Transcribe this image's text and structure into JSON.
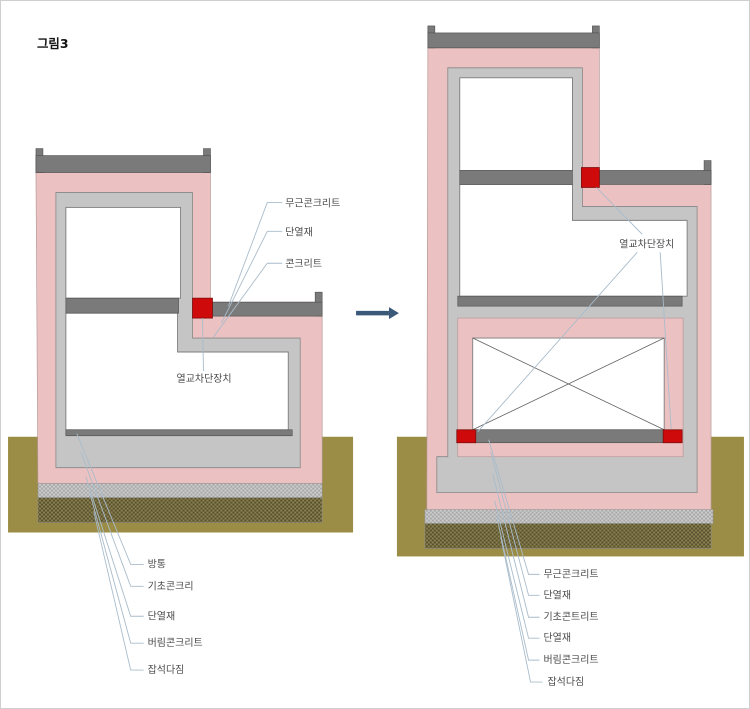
{
  "figure_title": "그림3",
  "left_diagram": {
    "top_labels": [
      "무근콘크리트",
      "단열재",
      "콘크리트"
    ],
    "middle_label": "열교차단장치",
    "bottom_labels": [
      "방통",
      "기초콘크리",
      "단열재",
      "버림콘크리트",
      "잡석다짐"
    ]
  },
  "right_diagram": {
    "middle_label": "열교차단장치",
    "bottom_labels": [
      "무근콘크리트",
      "단열재",
      "기초콘트리트",
      "단열재",
      "버림콘크리트",
      "잡석다짐"
    ]
  },
  "colors": {
    "insulation_pink": "#ecc1c1",
    "concrete_gray": "#c5c5c5",
    "slab_dark_gray": "#7a7a7a",
    "thermal_break_red": "#cf0a0a",
    "ground_olive": "#9b8d45",
    "leader_line_blue": "#a9bccb",
    "arrow_blue": "#3b5a7a"
  }
}
